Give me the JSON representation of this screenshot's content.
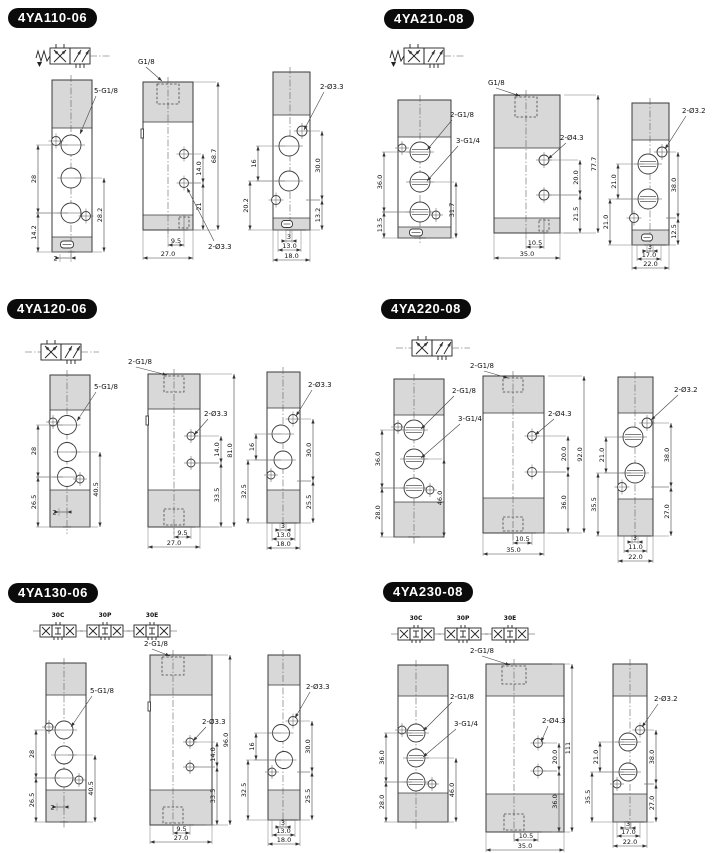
{
  "page": {
    "background": "#ffffff",
    "line_color": "#3a3a3a",
    "shade_color": "#d8d8d8",
    "badge_bg": "#0b0b0b",
    "badge_text_color": "#ffffff"
  },
  "sections": [
    {
      "title": "4YA110-06",
      "symbol": "5/2-single-solenoid-spring-return",
      "symbol_labels": [],
      "views": {
        "front": {
          "port_labels": [
            "5-G1/8"
          ],
          "dims": {
            "left": [
              "28",
              "14.2"
            ],
            "right": [
              "28.2"
            ],
            "bottom": [
              "2"
            ]
          }
        },
        "side": {
          "port_labels": [
            "G1/8",
            "2-Ø3.3"
          ],
          "dims": {
            "right": [
              "14.0",
              "21",
              "68.7"
            ],
            "bottom": [
              "9.5",
              "27.0"
            ]
          }
        },
        "back": {
          "port_labels": [
            "2-Ø3.3"
          ],
          "dims": {
            "left": [
              "16",
              "20.2"
            ],
            "right": [
              "30.0",
              "13.2"
            ],
            "bottom": [
              "3",
              "13.0",
              "18.0"
            ]
          }
        }
      }
    },
    {
      "title": "4YA210-08",
      "symbol": "5/2-single-solenoid-spring-return",
      "symbol_labels": [],
      "views": {
        "front": {
          "port_labels": [
            "2-G1/8",
            "3-G1/4"
          ],
          "dims": {
            "left": [
              "36.0",
              "13.5"
            ],
            "right": [
              "31.7"
            ],
            "bottom": []
          }
        },
        "side": {
          "port_labels": [
            "G1/8",
            "2-Ø4.3"
          ],
          "dims": {
            "right": [
              "20.0",
              "21.5",
              "77.7"
            ],
            "bottom": [
              "10.5",
              "35.0"
            ]
          }
        },
        "back": {
          "port_labels": [
            "2-Ø3.2"
          ],
          "dims": {
            "left": [
              "21.0",
              "21.0"
            ],
            "right": [
              "38.0",
              "12.5"
            ],
            "bottom": [
              "3",
              "17.0",
              "22.0"
            ]
          }
        }
      }
    },
    {
      "title": "4YA120-06",
      "symbol": "5/2-double-pilot",
      "symbol_labels": [],
      "views": {
        "front": {
          "port_labels": [
            "5-G1/8"
          ],
          "dims": {
            "left": [
              "28",
              "26.5"
            ],
            "right": [
              "40.5"
            ],
            "bottom": [
              "2"
            ]
          }
        },
        "side": {
          "port_labels": [
            "2-G1/8",
            "2-Ø3.3"
          ],
          "dims": {
            "right": [
              "14.0",
              "33.5",
              "81.0"
            ],
            "bottom": [
              "9.5",
              "27.0"
            ]
          }
        },
        "back": {
          "port_labels": [
            "2-Ø3.3"
          ],
          "dims": {
            "left": [
              "16",
              "32.5"
            ],
            "right": [
              "30.0",
              "25.5"
            ],
            "bottom": [
              "3",
              "13.0",
              "18.0"
            ]
          }
        }
      }
    },
    {
      "title": "4YA220-08",
      "symbol": "5/2-double-pilot",
      "symbol_labels": [],
      "views": {
        "front": {
          "port_labels": [
            "2-G1/8",
            "3-G1/4"
          ],
          "dims": {
            "left": [
              "36.0",
              "28.0"
            ],
            "right": [
              "46.0"
            ],
            "bottom": []
          }
        },
        "side": {
          "port_labels": [
            "2-G1/8",
            "2-Ø4.3"
          ],
          "dims": {
            "right": [
              "20.0",
              "36.0",
              "92.0"
            ],
            "bottom": [
              "10.5",
              "35.0"
            ]
          }
        },
        "back": {
          "port_labels": [
            "2-Ø3.2"
          ],
          "dims": {
            "left": [
              "21.0",
              "35.5"
            ],
            "right": [
              "38.0",
              "27.0"
            ],
            "bottom": [
              "3",
              "11.0",
              "22.0"
            ]
          }
        }
      }
    },
    {
      "title": "4YA130-06",
      "symbol": "5/3-three-position",
      "symbol_labels": [
        "30C",
        "30P",
        "30E"
      ],
      "views": {
        "front": {
          "port_labels": [
            "5-G1/8"
          ],
          "dims": {
            "left": [
              "28",
              "26.5"
            ],
            "right": [
              "40.5"
            ],
            "bottom": [
              "2"
            ]
          }
        },
        "side": {
          "port_labels": [
            "2-G1/8",
            "2-Ø3.3"
          ],
          "dims": {
            "right": [
              "14.0",
              "33.5",
              "96.0"
            ],
            "bottom": [
              "9.5",
              "27.0"
            ]
          }
        },
        "back": {
          "port_labels": [
            "2-Ø3.3"
          ],
          "dims": {
            "left": [
              "16",
              "32.5"
            ],
            "right": [
              "30.0",
              "25.5"
            ],
            "bottom": [
              "3",
              "13.0",
              "18.0"
            ]
          }
        }
      }
    },
    {
      "title": "4YA230-08",
      "symbol": "5/3-three-position",
      "symbol_labels": [
        "30C",
        "30P",
        "30E"
      ],
      "views": {
        "front": {
          "port_labels": [
            "2-G1/8",
            "3-G1/4"
          ],
          "dims": {
            "left": [
              "36.0",
              "28.0"
            ],
            "right": [
              "46.0"
            ],
            "bottom": []
          }
        },
        "side": {
          "port_labels": [
            "2-G1/8",
            "2-Ø4.3"
          ],
          "dims": {
            "right": [
              "20.0",
              "36.0",
              "111"
            ],
            "bottom": [
              "10.5",
              "35.0"
            ]
          }
        },
        "back": {
          "port_labels": [
            "2-Ø3.2"
          ],
          "dims": {
            "left": [
              "21.0",
              "35.5"
            ],
            "right": [
              "38.0",
              "27.0"
            ],
            "bottom": [
              "3",
              "17.0",
              "22.0"
            ]
          }
        }
      }
    }
  ]
}
